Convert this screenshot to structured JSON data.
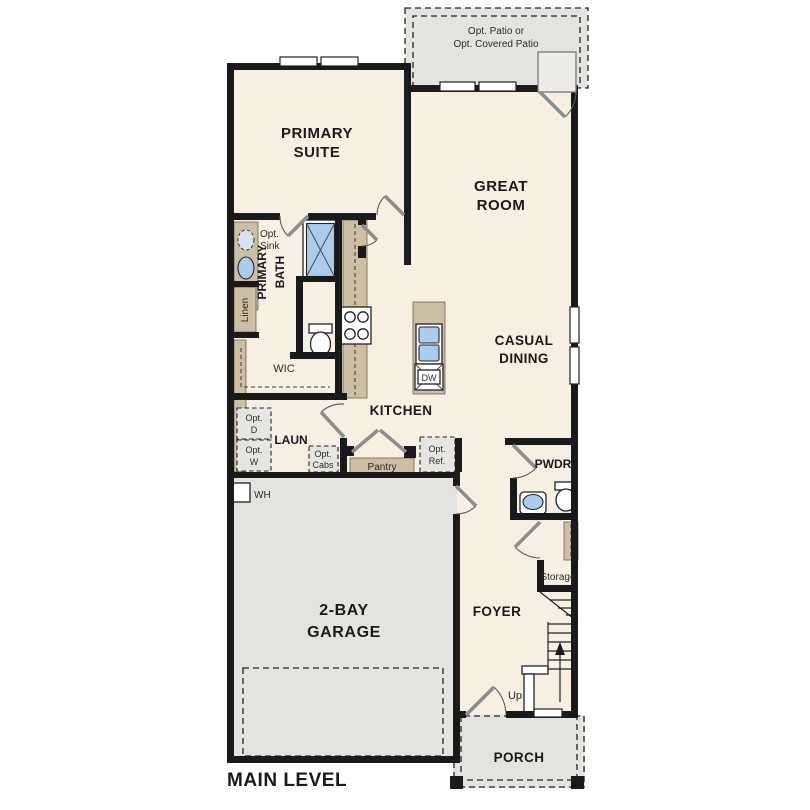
{
  "plan": {
    "title": "MAIN LEVEL",
    "colors": {
      "floor": "#f7efe1",
      "exterior": "#e4e3e0",
      "counter": "#cdbfa3",
      "fixture_blue": "#abccea",
      "wall": "#1a1a1a",
      "label": "#1a1a1a"
    },
    "rooms": {
      "primary_suite": {
        "line1": "PRIMARY",
        "line2": "SUITE"
      },
      "great_room": {
        "line1": "GREAT",
        "line2": "ROOM"
      },
      "casual_dining": {
        "line1": "CASUAL",
        "line2": "DINING"
      },
      "kitchen": {
        "label": "KITCHEN"
      },
      "primary_bath": {
        "line1": "PRIMARY",
        "line2": "BATH"
      },
      "wic": {
        "label": "WIC"
      },
      "laundry": {
        "label": "LAUN"
      },
      "powder": {
        "label": "PWDR"
      },
      "foyer": {
        "label": "FOYER"
      },
      "garage": {
        "line1": "2-BAY",
        "line2": "GARAGE"
      },
      "porch": {
        "label": "PORCH"
      },
      "storage": {
        "label": "Storage"
      },
      "pantry": {
        "label": "Pantry"
      },
      "linen": {
        "label": "Linen"
      }
    },
    "fixtures": {
      "water_heater": "WH",
      "dishwasher": "DW",
      "stairs_up": "Up"
    },
    "options": {
      "patio_line1": "Opt. Patio or",
      "patio_line2": "Opt. Covered Patio",
      "sink_line1": "Opt.",
      "sink_line2": "Sink",
      "dryer_line1": "Opt.",
      "dryer_line2": "D",
      "washer_line1": "Opt.",
      "washer_line2": "W",
      "cabs_line1": "Opt.",
      "cabs_line2": "Cabs",
      "ref_line1": "Opt.",
      "ref_line2": "Ref."
    }
  }
}
